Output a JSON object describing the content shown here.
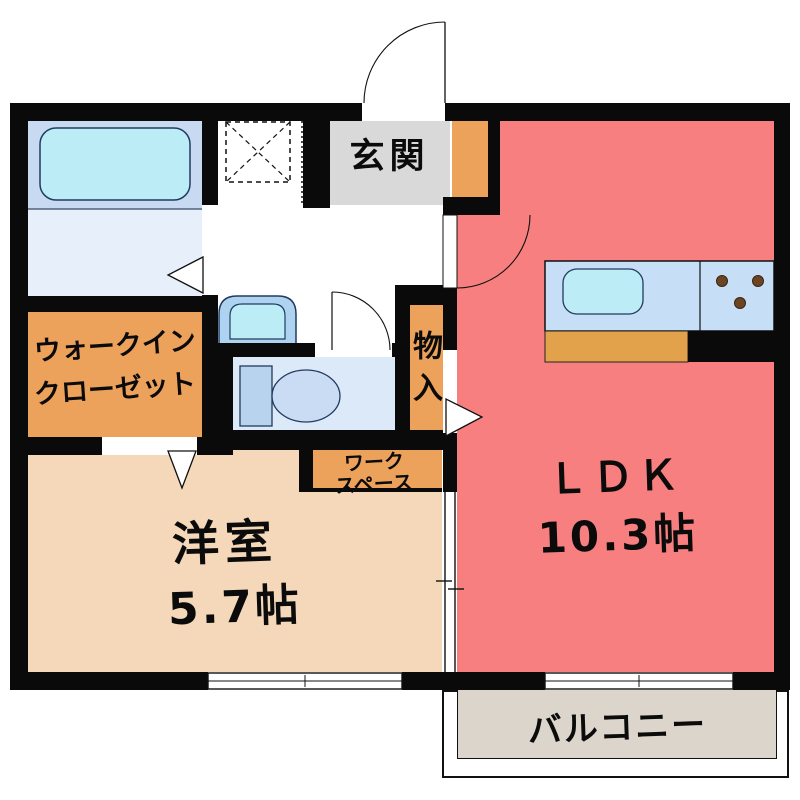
{
  "plan_title": "1LDK apartment floor plan",
  "rooms": {
    "genkan": {
      "label": "玄関"
    },
    "walk_in_closet": {
      "line1": "ウォークイン",
      "line2": "クローゼット"
    },
    "storage": {
      "label": "物入"
    },
    "workspace": {
      "line1": "ワーク",
      "line2": "スペース"
    },
    "western_room": {
      "label": "洋室",
      "area": "5.7帖"
    },
    "ldk": {
      "label": "ＬＤＫ",
      "area": "10.3帖"
    },
    "balcony": {
      "label": "バルコニー"
    }
  },
  "colors": {
    "wall": "#0A0A0A",
    "ldk": "#F87F7F",
    "western": "#F5D7B9",
    "storage": "#EDA25B",
    "genkan": "#D9D9D9",
    "balcony": "#DCD5CB",
    "bath_upper": "#C7DAF1",
    "bath_lower": "#E7F0FA",
    "toilet_floor": "#DCE9F8",
    "tub": "#BCEDF7",
    "sink_outer": "#AED3F0",
    "toilet_tank": "#B7D3EE",
    "toilet_bowl": "#CADCF4",
    "kitchen_counter": "#C6DFF6",
    "kitchen_cabinet": "#E2A24B",
    "burner": "#6B4423"
  }
}
